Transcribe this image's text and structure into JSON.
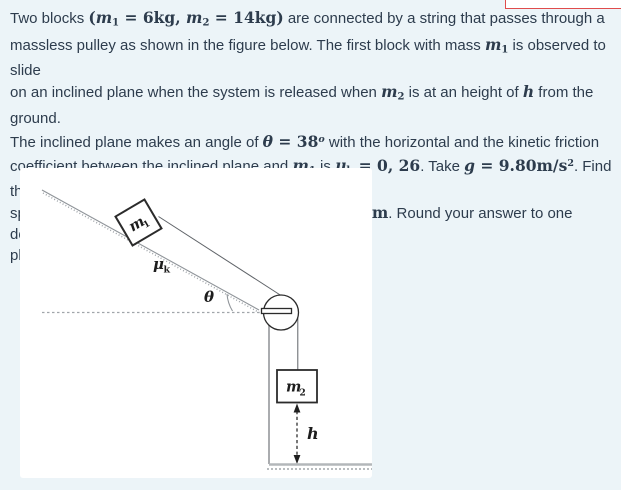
{
  "page": {
    "background": "#ecf4f8",
    "text_color": "#2d3c4d",
    "accent_red": "#e04c4c"
  },
  "problem": {
    "segments": [
      {
        "s": "t",
        "x": "Two blocks "
      },
      {
        "s": "r",
        "x": "("
      },
      {
        "s": "v",
        "x": "m"
      },
      {
        "s": "sb",
        "x": "1"
      },
      {
        "s": "r",
        "x": " = 6kg, "
      },
      {
        "s": "v",
        "x": "m"
      },
      {
        "s": "sb",
        "x": "2"
      },
      {
        "s": "r",
        "x": " = 14kg)"
      },
      {
        "s": "t",
        "x": " are connected by a string that passes through a"
      },
      {
        "s": "br"
      },
      {
        "s": "t",
        "x": "massless pulley as shown in the figure below. The first block with mass "
      },
      {
        "s": "v",
        "x": "m"
      },
      {
        "s": "sb",
        "x": "1"
      },
      {
        "s": "t",
        "x": " is observed to slide"
      },
      {
        "s": "br"
      },
      {
        "s": "t",
        "x": "on an inclined plane when the system is released when "
      },
      {
        "s": "v",
        "x": "m"
      },
      {
        "s": "sb",
        "x": "2"
      },
      {
        "s": "t",
        "x": " is at an height of "
      },
      {
        "s": "v",
        "x": "h"
      },
      {
        "s": "t",
        "x": " from the ground."
      },
      {
        "s": "br"
      },
      {
        "s": "t",
        "x": "The inclined plane makes an angle of "
      },
      {
        "s": "v",
        "x": "θ"
      },
      {
        "s": "r",
        "x": " = 38"
      },
      {
        "s": "spv",
        "x": "o"
      },
      {
        "s": "t",
        "x": " with the horizontal and the kinetic friction"
      },
      {
        "s": "br"
      },
      {
        "s": "t",
        "x": "coefficient between the inclined plane and "
      },
      {
        "s": "v",
        "x": "m"
      },
      {
        "s": "sb",
        "x": "1"
      },
      {
        "s": "t",
        "x": " is "
      },
      {
        "s": "v",
        "x": "μ"
      },
      {
        "s": "sb",
        "x": "k"
      },
      {
        "s": "r",
        "x": " = 0, 26"
      },
      {
        "s": "t",
        "x": ". Take "
      },
      {
        "s": "v",
        "x": "g"
      },
      {
        "s": "r",
        "x": " = 9.80m/s"
      },
      {
        "s": "sp",
        "x": "2"
      },
      {
        "s": "t",
        "x": ". Find the"
      },
      {
        "s": "br"
      },
      {
        "s": "t",
        "x": "speed of the block with mass m2 after it travels "
      },
      {
        "s": "v",
        "x": "h"
      },
      {
        "s": "r",
        "x": " = 7m"
      },
      {
        "s": "t",
        "x": ". Round your answer to one decimal"
      },
      {
        "s": "br"
      },
      {
        "s": "t",
        "x": "place."
      }
    ]
  },
  "figure": {
    "labels": {
      "m1_main": "m",
      "m1_sub": "1",
      "mu_main": "μ",
      "mu_sub": "k",
      "theta": "θ",
      "m2_main": "m",
      "m2_sub": "2",
      "h": "h"
    },
    "colors": {
      "panel": "#ffffff",
      "dark_line": "#2b2b2b",
      "gray_line": "#9aa0a4",
      "ground_line": "#b3b7ba"
    }
  }
}
